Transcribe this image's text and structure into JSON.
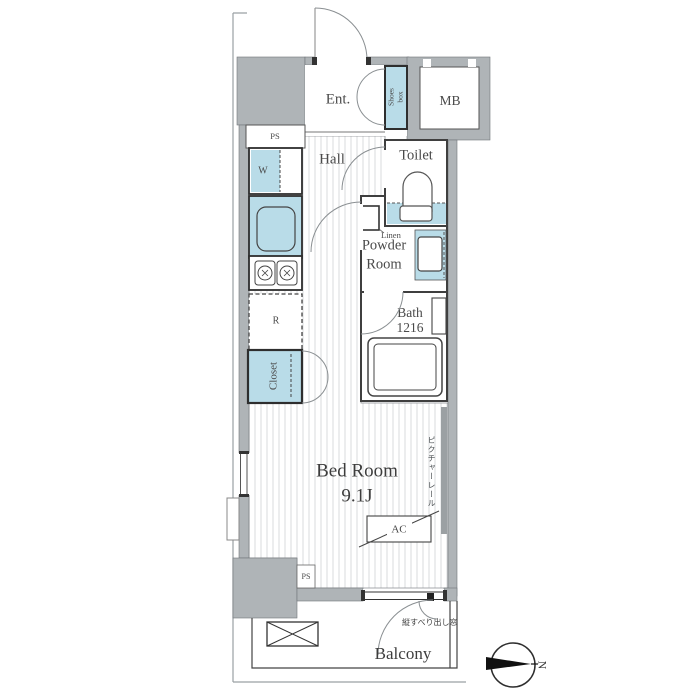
{
  "rooms": {
    "entrance": {
      "label": "Ent."
    },
    "shoes_box": {
      "line1": "Shoes",
      "line2": "box"
    },
    "meter_box": {
      "label": "MB"
    },
    "hall": {
      "label": "Hall"
    },
    "toilet": {
      "label": "Toilet"
    },
    "powder_room": {
      "line1": "Powder",
      "line2": "Room"
    },
    "linen": {
      "label": "Linen"
    },
    "bath": {
      "line1": "Bath",
      "line2": "1216"
    },
    "bedroom": {
      "line1": "Bed Room",
      "line2": "9.1J"
    },
    "closet": {
      "label": "Closet"
    },
    "balcony": {
      "label": "Balcony"
    }
  },
  "fixtures": {
    "washer_label": "W",
    "refrigerator_label": "R",
    "ac_label": "AC",
    "pipe_space_top": "PS",
    "pipe_space_bottom": "PS"
  },
  "annotations": {
    "picture_rail": "ピクチャーレール",
    "casement_window": "縦すべり出し窓",
    "north": "N"
  },
  "colors": {
    "wall_gray": "#afb4b7",
    "fixture_blue": "#b9dce8",
    "partition_dark": "#3f3f3f",
    "floor_hatch": "#d9dbdc",
    "label_text": "#4a4a4a"
  }
}
